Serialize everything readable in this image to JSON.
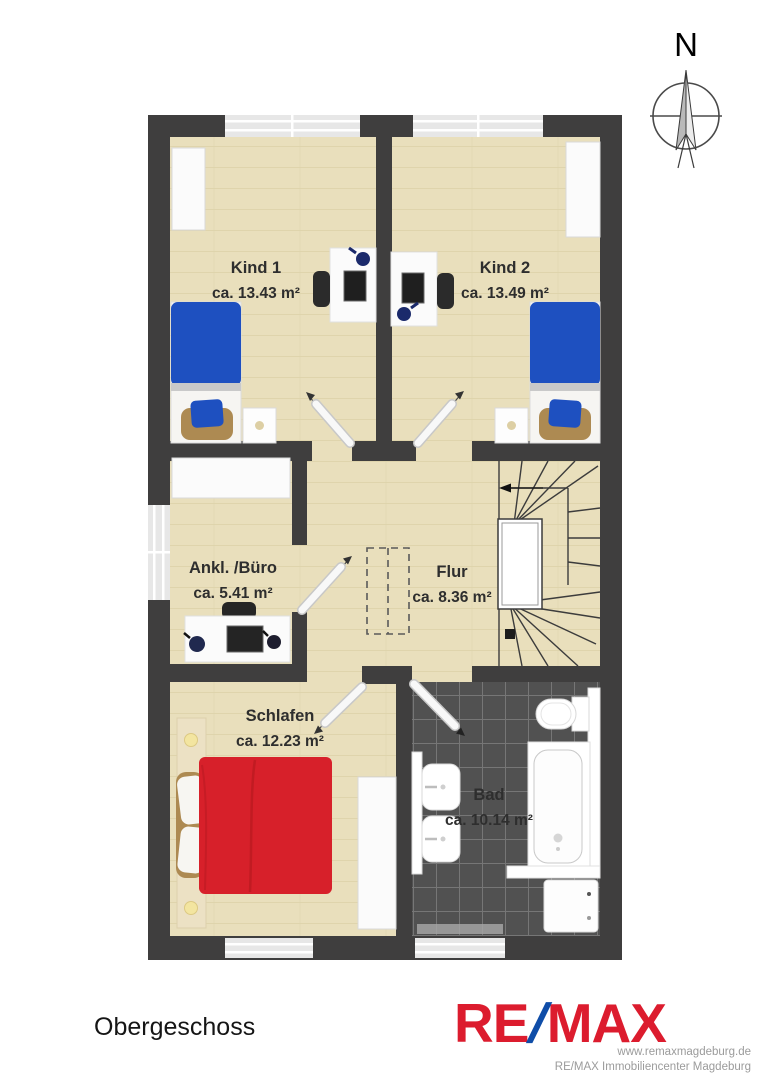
{
  "compass": {
    "label": "N"
  },
  "rooms": [
    {
      "id": "kind1",
      "name": "Kind 1",
      "area": "ca. 13.43 m²"
    },
    {
      "id": "kind2",
      "name": "Kind 2",
      "area": "ca. 13.49 m²"
    },
    {
      "id": "ankl-buero",
      "name": "Ankl. /Büro",
      "area": "ca. 5.41 m²"
    },
    {
      "id": "flur",
      "name": "Flur",
      "area": "ca. 8.36 m²"
    },
    {
      "id": "schlafen",
      "name": "Schlafen",
      "area": "ca. 12.23 m²"
    },
    {
      "id": "bad",
      "name": "Bad",
      "area": "ca. 10.14 m²"
    }
  ],
  "footer": {
    "floor_label": "Obergeschoss",
    "logo": {
      "re": "RE",
      "slash": "/",
      "max": "MAX"
    },
    "website": "www.remaxmagdeburg.de",
    "company": "RE/MAX Immobiliencenter Magdeburg"
  },
  "colors": {
    "logo_red": "#DC1C2E",
    "logo_blue": "#0F4DA8",
    "wall": "#3F3E3E",
    "floor": "#E9DFBC",
    "bath_tile": "#515151",
    "window": "#E7E7E7",
    "bed_blue": "#1E50C0",
    "bed_red": "#D7202A"
  }
}
